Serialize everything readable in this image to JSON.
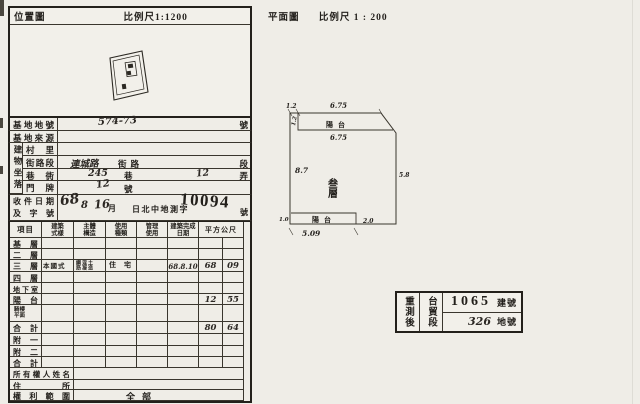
{
  "location_map": {
    "title": "位置圖",
    "scale": "比例尺1:1200"
  },
  "site": {
    "row1": {
      "label": "基地地號",
      "value": "574-73",
      "suffix": "號"
    },
    "row2": {
      "label": "基地來源"
    },
    "group_label": "建物坐落",
    "row3": {
      "label": "村里"
    },
    "row4": {
      "label": "街路段",
      "value": "連城路",
      "printed": "街路",
      "suffix": "段"
    },
    "row5": {
      "label": "巷衖",
      "value1": "245",
      "unit1": "巷",
      "value2": "12",
      "unit2": "弄"
    },
    "row6": {
      "label": "門牌",
      "value": "12",
      "suffix": "號"
    }
  },
  "receipt": {
    "label_line1": "收件日期",
    "label_line2": "及字號",
    "year": "68",
    "month": "8",
    "day": "16",
    "unit_month": "月",
    "office": "日北中地測字",
    "number": "10094",
    "unit": "號"
  },
  "table": {
    "headers": {
      "col0": "項目",
      "col1": "建築式樣",
      "col2": "主體構造",
      "col3": "使用種類",
      "col4": "管理使用",
      "col5": "建築完成日期",
      "col6": "平方公尺"
    },
    "rows": [
      {
        "label": "基層"
      },
      {
        "label": "二層"
      },
      {
        "label": "三層",
        "style": "本國式",
        "structure": "鋼筋混凝土造",
        "use": "住宅",
        "completed": "68.8.10",
        "sqm_int": "68",
        "sqm_dec": "09"
      },
      {
        "label": "四層"
      },
      {
        "label": "地下室"
      },
      {
        "label": "陽台",
        "sqm_int": "12",
        "sqm_dec": "55"
      },
      {
        "label": "騎樓平面"
      },
      {
        "label": "合計",
        "sqm_int": "80",
        "sqm_dec": "64"
      },
      {
        "label": "附一"
      },
      {
        "label": "附二"
      },
      {
        "label": "合計"
      },
      {
        "label": "所有權人姓名"
      },
      {
        "label": "住所"
      },
      {
        "label": "權利範圍",
        "value": "全部"
      }
    ]
  },
  "footer": "210×297mm用500號製圖原圖紙印製",
  "plan": {
    "title": "平面圖",
    "scale": "比例尺 1 : 200",
    "floor_label": "叁層",
    "balcony_top": "陽台",
    "balcony_bottom": "陽台",
    "dims": {
      "top_offset": "1.2",
      "top_width": "6.75",
      "left_offset": "1.2",
      "inner_width": "6.75",
      "left_height": "8.7",
      "right_height": "5.8",
      "bottom_strip_height": "1.0",
      "bottom_width": "5.09",
      "bottom_gap": "2.0"
    }
  },
  "stamp_box": {
    "col1": "重測後",
    "col2": "台貿段",
    "row1_value": "1065",
    "row1_unit": "建號",
    "row2_value": "326",
    "row2_unit": "地號"
  }
}
